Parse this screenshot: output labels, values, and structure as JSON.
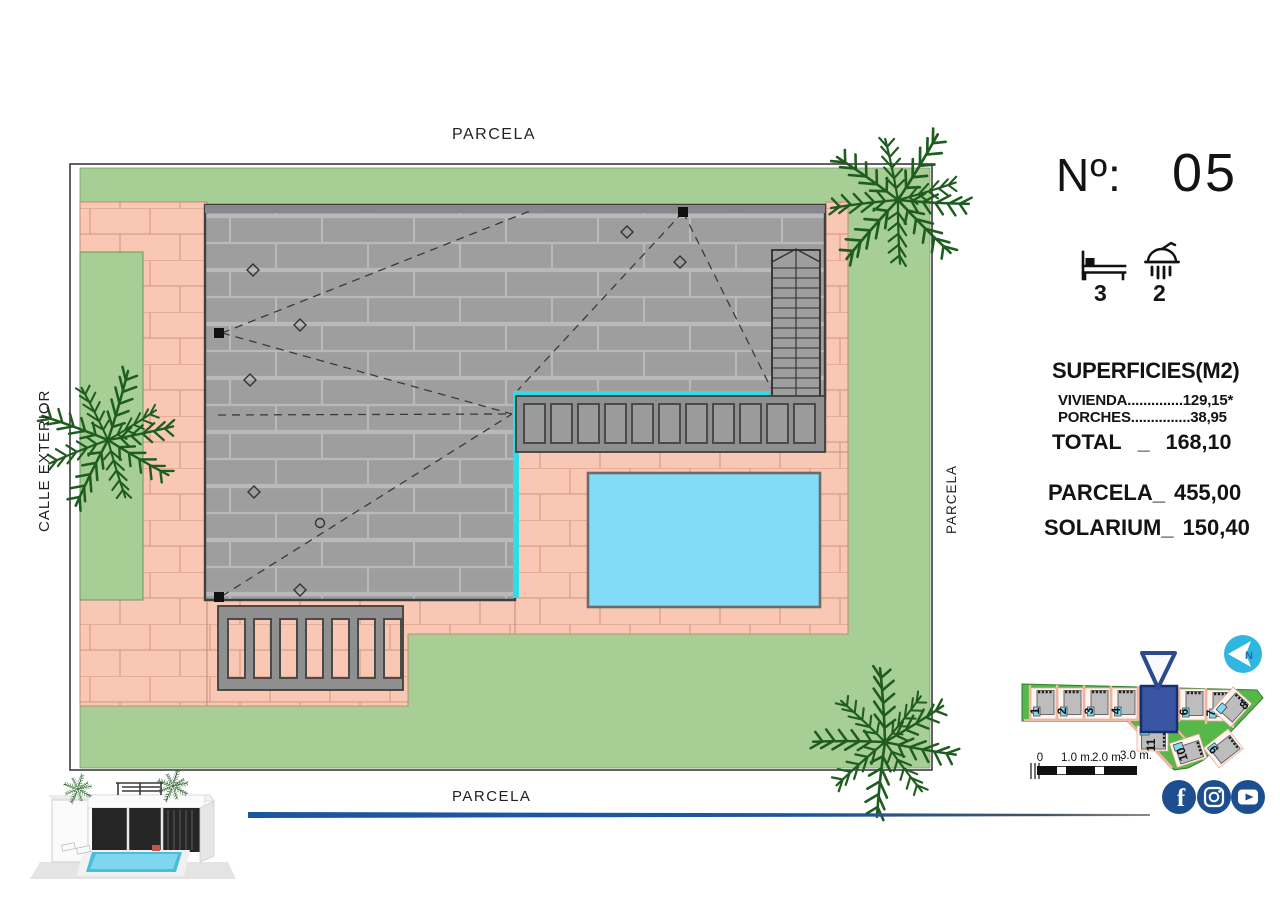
{
  "plan": {
    "label_top": "PARCELA",
    "label_bottom": "PARCELA",
    "label_right": "PARCELA",
    "label_left": "CALLE EXTERIOR"
  },
  "info": {
    "number_label": "Nº:",
    "number_value": "05",
    "bedrooms": "3",
    "bathrooms": "2",
    "surfaces_title": "SUPERFICIES(M2)",
    "row_vivienda": "VIVIENDA..............129,15*",
    "row_porches": "PORCHES...............38,95",
    "total_label": "TOTAL",
    "total_sep": "_",
    "total_value": "168,10",
    "parcela_label": "PARCELA_",
    "parcela_value": "455,00",
    "solarium_label": "SOLARIUM_",
    "solarium_value": "150,40"
  },
  "site_map": {
    "plots": [
      "1",
      "2",
      "3",
      "4",
      "5",
      "6",
      "7",
      "8",
      "9",
      "10",
      "11"
    ],
    "highlighted_plot": "5",
    "compass_letter": "N",
    "scale_ticks": [
      "0",
      "1.0 m.",
      "2.0 m.",
      "3.0 m."
    ]
  },
  "social": {
    "icons": [
      "facebook",
      "instagram",
      "youtube"
    ],
    "facebook_glyph": "f"
  },
  "colors": {
    "navy": "#1d4f90",
    "cyan_edge": "#2fdce8",
    "lawn": "#a7ce95",
    "paving": "#f8c8b4",
    "roof": "#9e9e9e",
    "pool": "#82dcf7",
    "map_green": "#55b848",
    "compass_cyan": "#2fb7e2",
    "divider_blue": "#1a57a0"
  }
}
